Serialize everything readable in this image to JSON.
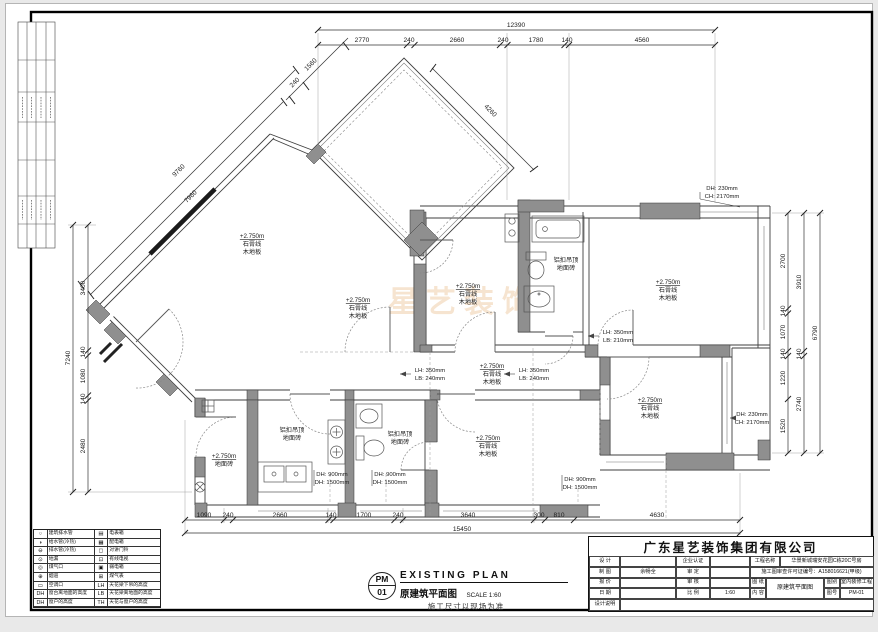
{
  "watermark": {
    "text": "星艺装饰"
  },
  "plan": {
    "floor_label": {
      "elev": "+2.750m",
      "line": "石膏线",
      "floor": "木地板"
    },
    "entry_label": {
      "elev": "+2.750m",
      "floor": "地面砖"
    },
    "ceil_label": {
      "l1": "铝扣吊顶",
      "l2": "地面砖"
    },
    "beam_240": {
      "l1": "LH: 350mm",
      "l2": "LB: 240mm"
    },
    "beam_210": {
      "l1": "LH: 350mm",
      "l2": "LB: 210mm"
    },
    "win_230": {
      "l1": "DH: 230mm",
      "l2": "CH: 2170mm"
    },
    "win_900": {
      "l1": "DH: 900mm",
      "l2": "DH: 1500mm"
    }
  },
  "dims": {
    "top": {
      "total": "12390",
      "segments": [
        "2770",
        "240",
        "2660",
        "240",
        "1780",
        "140",
        "4560"
      ]
    },
    "bottom": {
      "total": "15450",
      "segments": [
        "1090",
        "240",
        "2660",
        "140",
        "1700",
        "240",
        "3640",
        "300",
        "810",
        "4630"
      ]
    },
    "left": {
      "total": "7240",
      "segments": [
        "3400",
        "140",
        "1080",
        "140",
        "2480"
      ]
    },
    "right_inner": [
      "2700",
      "140",
      "1070",
      "140",
      "1220",
      "1520"
    ],
    "right_mid": [
      "3910",
      "140",
      "2740"
    ],
    "right_total": "6790",
    "diag": {
      "outer": "9760",
      "inner": "7960",
      "balcony": "4260",
      "side": "1560",
      "wall": "240"
    }
  },
  "titlebar": {
    "code_top": "PM",
    "code_bottom": "01",
    "title_en": "EXISTING PLAN",
    "title_cn": "原建筑平面图",
    "scale": "SCALE 1:60",
    "note": "施工尺寸以现场为准"
  },
  "titleblock": {
    "company": "广东星艺装饰集团有限公司",
    "design_label": "设 计",
    "draft_label": "制 图",
    "draft_value": "余畅全",
    "quote_label": "报 价",
    "date_label": "日 期",
    "note_label": "设计说明",
    "cert_label": "企业认证",
    "approve_label": "审 定",
    "check_label": "审 核",
    "scale_label": "比 例",
    "scale_value": "1:60",
    "project_label": "工程名称",
    "project_value": "华景新城瑞安花园C栋20C号房",
    "license": "施工图审查许可证编号：A158016621(甲级)",
    "sheet_label": "图 纸",
    "content_label": "内 容",
    "sheet_value": "原建筑平面图",
    "type_label": "图别",
    "type_value": "室内装修工程",
    "no_label": "图号",
    "no_value": "PM-01"
  },
  "legend": {
    "rows": [
      {
        "ls": "○",
        "ll": "建筑排水管",
        "rs": "▤",
        "rl": "电表箱"
      },
      {
        "ls": "◑",
        "ll": "给水管(冷热)",
        "rs": "▦",
        "rl": "配电箱"
      },
      {
        "ls": "⊖",
        "ll": "排水管(冷热)",
        "rs": "◻",
        "rl": "对讲门铃"
      },
      {
        "ls": "⊙",
        "ll": "地漏",
        "rs": "⊡",
        "rl": "有线电视"
      },
      {
        "ls": "◎",
        "ll": "煤气口",
        "rs": "▣",
        "rl": "弱电箱"
      },
      {
        "ls": "⊕",
        "ll": "烟道",
        "rs": "⊞",
        "rl": "煤气表"
      },
      {
        "ls": "▭",
        "ll": "空调口",
        "rs": "LH",
        "rl": "天花梁下吊的高度"
      },
      {
        "ls": "DH",
        "ll": "窗台离地面的高度",
        "rs": "LB",
        "rl": "天花梁离地面的高度"
      },
      {
        "ls": "DH",
        "ll": "窗户的高度",
        "rs": "TH",
        "rl": "天花与窗户的高度"
      }
    ]
  }
}
